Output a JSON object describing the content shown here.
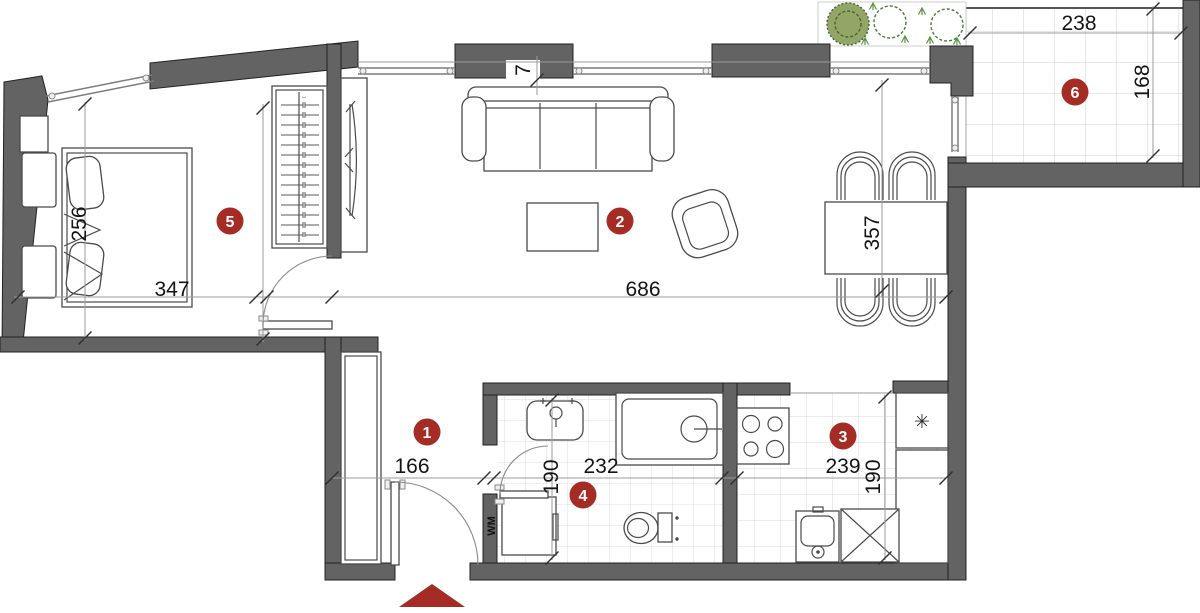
{
  "plan": {
    "type": "apartment-floor-plan",
    "unit_note": "dimension figures as printed on plan",
    "rooms": [
      {
        "number": "1",
        "name": "hallway"
      },
      {
        "number": "2",
        "name": "living-room"
      },
      {
        "number": "3",
        "name": "kitchen"
      },
      {
        "number": "4",
        "name": "bathroom"
      },
      {
        "number": "5",
        "name": "bedroom"
      },
      {
        "number": "6",
        "name": "balcony"
      }
    ],
    "dims": {
      "bedroom_width": "347",
      "bedroom_depth": "256",
      "living_width": "686",
      "dining_depth": "357",
      "wall_pier": "7",
      "hall_width": "166",
      "bath_width": "232",
      "bath_depth": "190",
      "kitchen_width": "239",
      "kitchen_depth": "190",
      "balcony_width": "238",
      "balcony_depth": "168"
    },
    "labels": {
      "washing_machine": "WM",
      "fridge_symbol": "✳"
    },
    "colors": {
      "wall": "#636363",
      "furniture_line": "#4a4a4a",
      "dimension_line": "#9b9b9b",
      "tile_line": "#dcdcdc",
      "badge": "#a52c24",
      "entrance_marker": "#a52c24",
      "bush_fill": "#93a668",
      "bush_stroke": "#41682c",
      "shrub_stroke": "#477d35",
      "sprout": "#55933f"
    }
  }
}
